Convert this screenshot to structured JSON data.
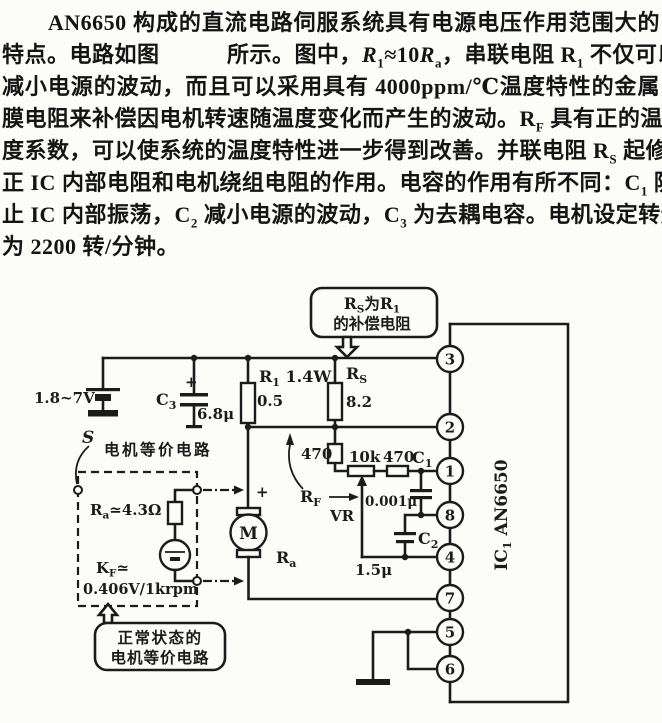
{
  "colors": {
    "ink": "#1b1b1b",
    "paper": "#fcfcf9"
  },
  "paragraph": {
    "lines": [
      "　　AN6650 构成的直流电路伺服系统具有电源电压作用范围大的",
      "特点。电路如图　　　所示。图中，<i>R</i><sub>1</sub>≈10<i>R</i><sub>a</sub>，串联电阻 R<sub>1</sub> 不仅可以",
      "减小电源的波动，而且可以采用具有 4000ppm/℃温度特性的金属",
      "膜电阻来补偿因电机转速随温度变化而产生的波动。R<sub>F</sub> 具有正的温",
      "度系数，可以使系统的温度特性进一步得到改善。并联电阻 R<sub>S</sub> 起修",
      "正 IC 内部电阻和电机绕组电阻的作用。电容的作用有所不同：C<sub>1</sub> 防",
      "止 IC 内部振荡，C<sub>2</sub> 减小电源的波动，C<sub>3</sub> 为去耦电容。电机设定转速",
      "为 2200 转/分钟。"
    ]
  },
  "circuit": {
    "supply": "1.8~7V",
    "c3": {
      "main": "C",
      "sub": "3",
      "plus": "+",
      "value": "6.8μ"
    },
    "r1": {
      "main": "R",
      "sub": "1",
      "rest": " 1.4W",
      "value": "0.5"
    },
    "rs": {
      "main": "R",
      "sub": "S",
      "value": "8.2"
    },
    "r470a": "470",
    "pot": "10k",
    "r470b": "470",
    "c1": {
      "main": "C",
      "sub": "1",
      "value": "0.001μ"
    },
    "c2": {
      "main": "C",
      "sub": "2",
      "value": "1.5μ"
    },
    "rf": {
      "main": "R",
      "sub": "F"
    },
    "vr": "VR",
    "callout_top": {
      "l1a": "R",
      "l1b": "S",
      "l1c": "为R",
      "l1d": "1",
      "l2": "的补偿电阻"
    },
    "callout_bottom": {
      "l1": "正常状态的",
      "l2": "电机等价电路"
    },
    "equiv": {
      "s": "S",
      "title": "电机等价电路",
      "ra_main": "R",
      "ra_sub": "a",
      "ra_rest": "≃4.3Ω",
      "kf_main": "K",
      "kf_sub": "F",
      "kf_rest": "≃",
      "kf_value": "0.406V/1krpm"
    },
    "motor": {
      "m": "M",
      "plus": "+",
      "ra_main": "R",
      "ra_sub": "a"
    },
    "ic": {
      "main": "IC",
      "sub": "1",
      "part": "AN6650"
    },
    "pins": [
      "3",
      "2",
      "1",
      "8",
      "4",
      "7",
      "5",
      "6"
    ]
  }
}
